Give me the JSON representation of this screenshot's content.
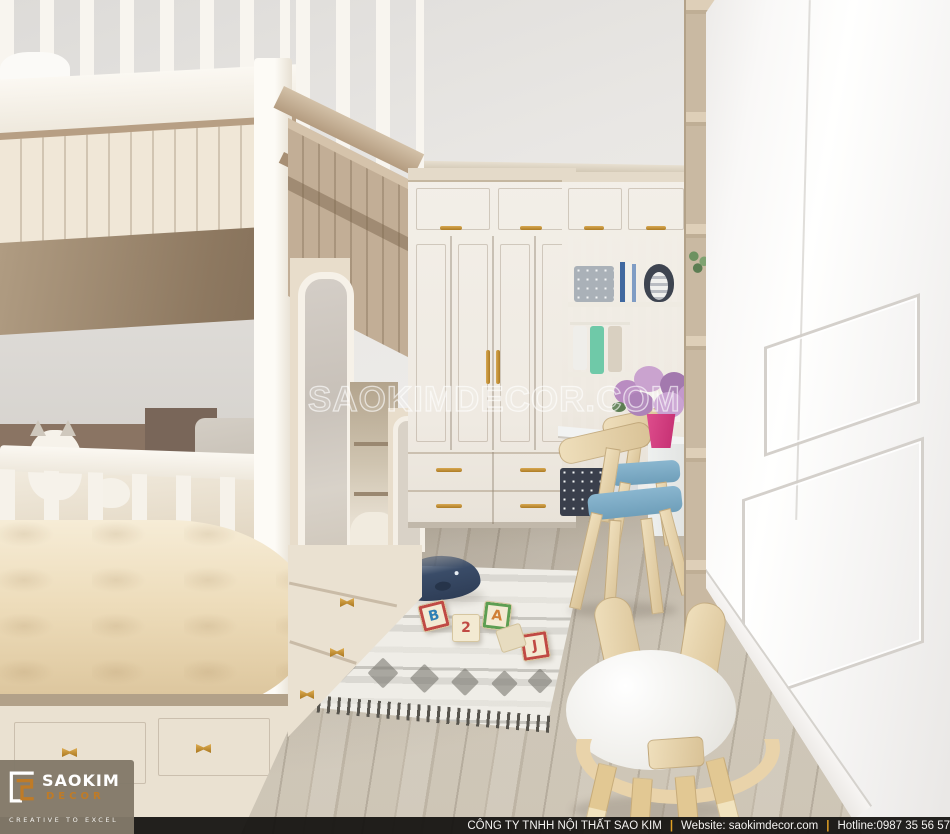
{
  "watermark": {
    "text": "SAOKIMDECOR.COM"
  },
  "logo": {
    "brand": "SAOKIM",
    "sub": "DECOR",
    "tagline": "CREATIVE TO EXCEL"
  },
  "footer": {
    "company": "CÔNG TY TNHH NỘI THẤT SAO KIM",
    "website": "Website: saokimdecor.com",
    "hotline": "Hotline:0987 35 56 57",
    "separator": "|"
  },
  "toys": {
    "block_letters": [
      "B",
      "2",
      "A",
      "J"
    ]
  },
  "scene_inventory": [
    "children bedroom 3d render",
    "cream bunk bed left",
    "tan bunk bed with arched niches",
    "white wardrobe with gold handles",
    "glass display cabinet",
    "hanging clothes",
    "polka-dot storage box",
    "penguin plush",
    "books",
    "purple flower bouquet in pink vase",
    "study desk",
    "two wooden chairs with blue seats",
    "tall beige open shelf",
    "white wainscot wall panel",
    "grey wood floor",
    "boho grey-white rug with tassels",
    "navy whale plush",
    "wooden alphabet blocks",
    "bunny-ear wooden stool",
    "cat plush on bed"
  ],
  "palette": {
    "accent_orange": "#bf7b27",
    "gold_handle": "#c9952e",
    "footer_bg": "#121110",
    "separator_orange": "#e2a124",
    "cream_wood": "#f0e7d7",
    "tan_wood": "#c2ae96",
    "seat_blue": "#7fb0ca",
    "whale_navy": "#2d3c55"
  }
}
